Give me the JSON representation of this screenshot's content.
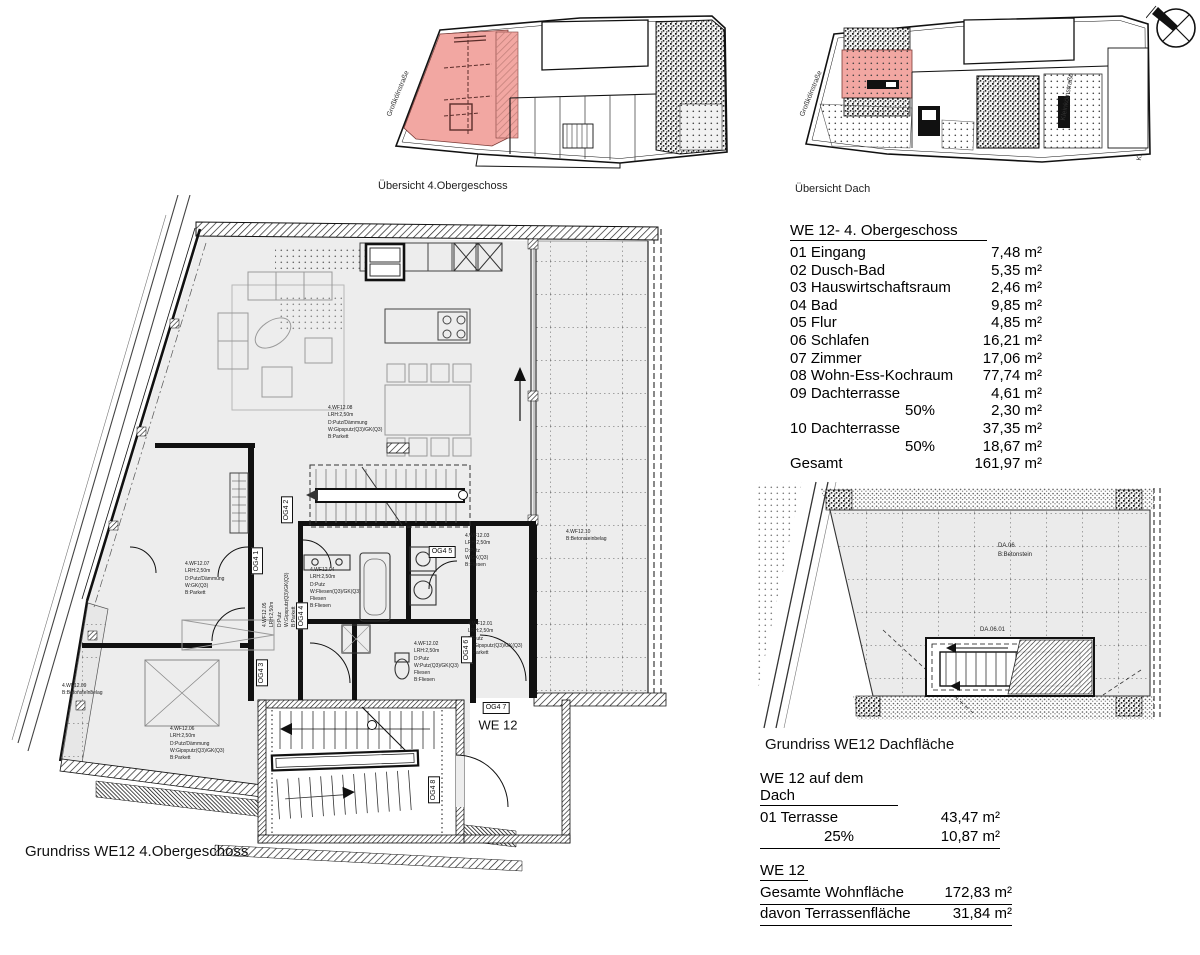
{
  "colors": {
    "highlight_pink": "#F2A7A2",
    "floor_gray": "#EDEDED",
    "line": "#111111"
  },
  "overview_og": {
    "caption": "Übersicht 4.Obergeschoss",
    "street_left": "Großkölnstraße",
    "street_right": "Kleinkölnstraße"
  },
  "overview_dach": {
    "caption": "Übersicht Dach",
    "street_left": "Großkölnstraße",
    "street_right": "Kleinkölnstraße"
  },
  "main_plan": {
    "caption": "Grundriss WE12 4.Obergeschoss",
    "unit_label": "WE 12",
    "tags": [
      "OG4 1",
      "OG4 2",
      "OG4 3",
      "OG4 4",
      "OG4 5",
      "OG4 6",
      "OG4 7",
      "OG4 8"
    ],
    "annotations": {
      "living": "4.WF12.08\nLRH:2,50m\nD:Putz/Dämmung\nW:Gipsputz(Q3)/GK(Q3)\nB:Parkett",
      "zimmer": "4.WF12.07\nLRH:2,50m\nD:Putz/Dämmung\nW:GK(Q3)\nB:Parkett",
      "schlafen": "4.WF12.06\nLRH:2,50m\nD:Putz/Dämmung\nW:Gipsputz(Q3)/GK(Q3)\nB:Parkett",
      "flur": "4.WF12.05\nLRH:2,50m\nD:Putz\nW:Gipsputz(Q3)/GK(Q3)\nB:Parkett",
      "bad": "4.WF12.04\nLRH:2,50m\nD:Putz\nW:Fliesen(Q3)/GK(Q3)\nFliesen\nB:Fliesen",
      "hwr": "4.WF12.03\nLRH:2,50m\nD:Putz\nW:GK(Q3)\nB:Fliesen",
      "duschbad": "4.WF12.02\nLRH:2,50m\nD:Putz\nW:Putz(Q3)/GK(Q3)\nFliesen\nB:Fliesen",
      "eingang": "4.WF12.01\nLRH:2,50m\nD:Putz\nW:Gipsputz(Q3)/GK(Q3)\nB:Parkett",
      "terrasse09": "4.WF12.09\nB:Betonsteinbelag",
      "terrasse10": "4.WF12.10\nB:Betonsteinbelag"
    }
  },
  "schedule": {
    "title": "WE 12- 4. Obergeschoss",
    "rows": [
      {
        "label": "01 Eingang",
        "value": "7,48 m²"
      },
      {
        "label": "02 Dusch-Bad",
        "value": "5,35 m²"
      },
      {
        "label": "03 Hauswirtschaftsraum",
        "value": "2,46 m²"
      },
      {
        "label": "04 Bad",
        "value": "9,85 m²"
      },
      {
        "label": "05 Flur",
        "value": "4,85 m²"
      },
      {
        "label": "06 Schlafen",
        "value": "16,21 m²"
      },
      {
        "label": "07 Zimmer",
        "value": "17,06 m²"
      },
      {
        "label": "08 Wohn-Ess-Kochraum",
        "value": "77,74 m²"
      },
      {
        "label": "09 Dachterrasse",
        "value": "4,61 m²"
      },
      {
        "label": "50%",
        "value": "2,30 m²"
      },
      {
        "label": "10 Dachterrasse",
        "value": "37,35 m²"
      },
      {
        "label": "50%",
        "value": "18,67 m²"
      },
      {
        "label": "Gesamt",
        "value": "161,97 m²"
      }
    ]
  },
  "roof_plan": {
    "caption": "Grundriss WE12 Dachfläche",
    "area_label": "DA.06\nB:Betonstein",
    "stair_label": "DA.06.01"
  },
  "roof_table": {
    "title": "WE 12 auf dem Dach",
    "rows": [
      {
        "label": "01  Terrasse",
        "value": "43,47 m²"
      },
      {
        "label": "25%",
        "value": "10,87 m²"
      }
    ]
  },
  "totals": {
    "title": "WE 12",
    "rows": [
      {
        "label": "Gesamte Wohnfläche",
        "value": "172,83 m²"
      },
      {
        "label": "davon Terrassenfläche",
        "value": "31,84 m²"
      }
    ]
  }
}
